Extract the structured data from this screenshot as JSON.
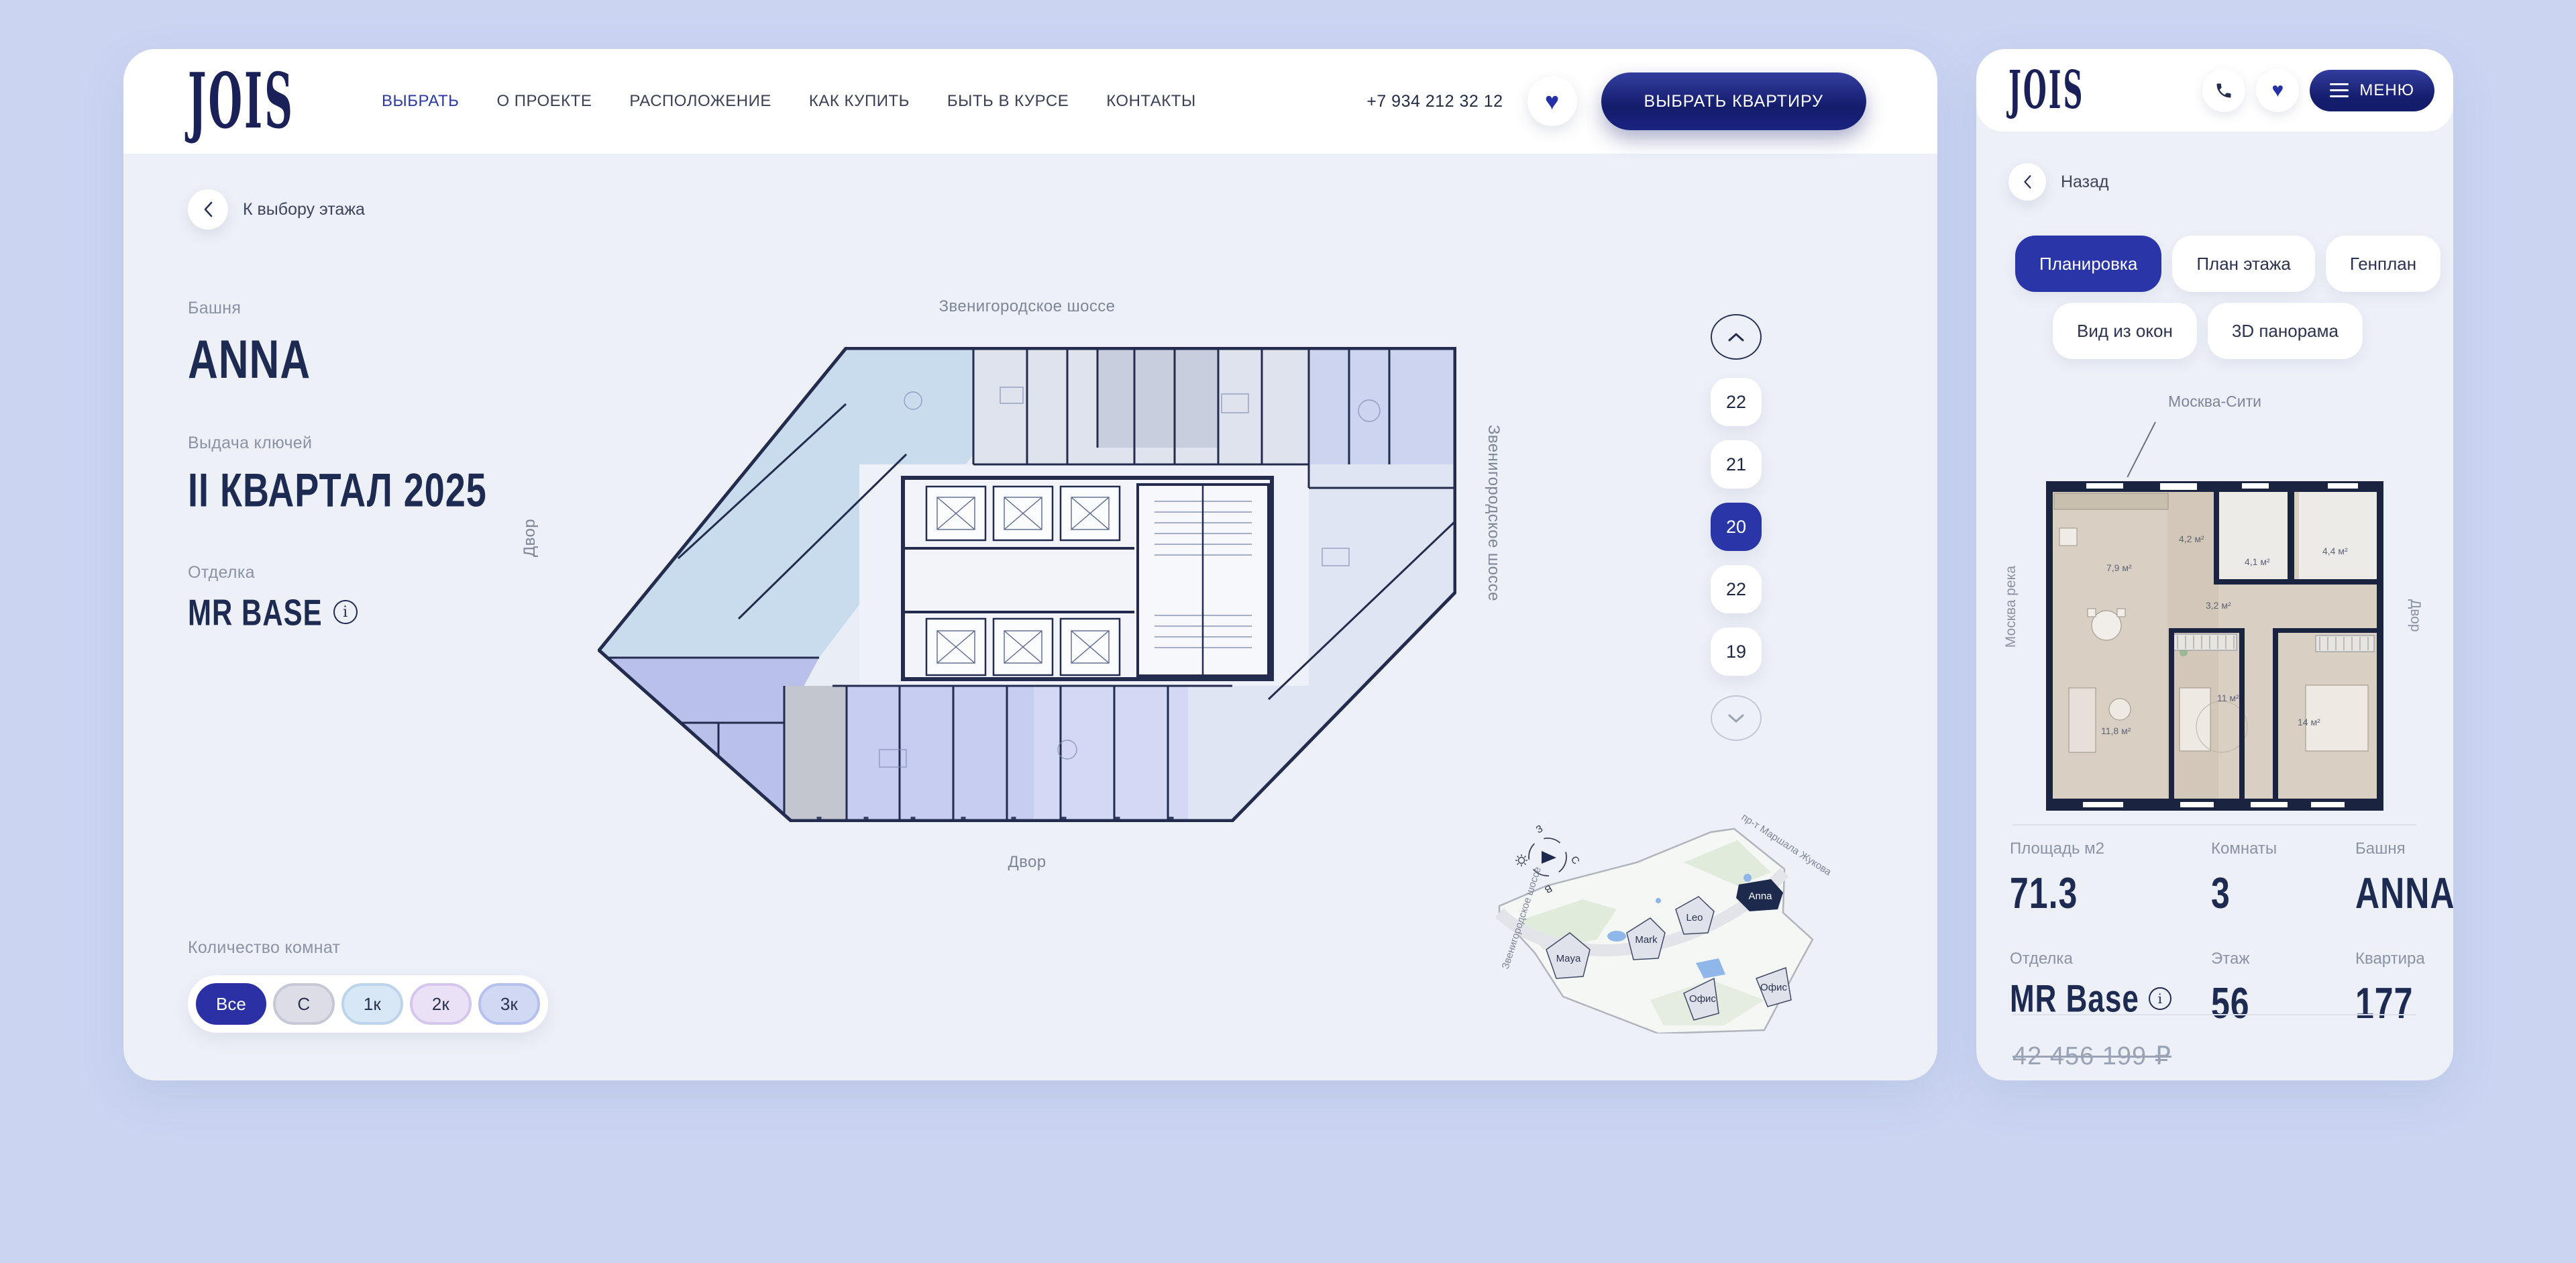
{
  "header": {
    "logo": "JOIS",
    "nav": [
      {
        "label": "ВЫБРАТЬ",
        "active": true
      },
      {
        "label": "О ПРОЕКТЕ",
        "active": false
      },
      {
        "label": "РАСПОЛОЖЕНИЕ",
        "active": false
      },
      {
        "label": "КАК КУПИТЬ",
        "active": false
      },
      {
        "label": "БЫТЬ В КУРСЕ",
        "active": false
      },
      {
        "label": "КОНТАКТЫ",
        "active": false
      }
    ],
    "phone": "+7 934 212 32 12",
    "cta": "ВЫБРАТЬ КВАРТИРУ"
  },
  "main": {
    "back": "К выбору этажа",
    "tower_label": "Башня",
    "tower": "ANNA",
    "keys_label": "Выдача ключей",
    "keys": "II КВАРТАЛ 2025",
    "finish_label": "Отделка",
    "finish": "MR BASE",
    "rooms_label": "Количество комнат",
    "filters": [
      "Все",
      "С",
      "1к",
      "2к",
      "3к"
    ],
    "plan_labels": {
      "top": "Звенигородское шоссе",
      "bottom": "Двор",
      "left": "Двор",
      "right": "Звенигородское шоссе"
    }
  },
  "floors": {
    "items": [
      "22",
      "21",
      "20",
      "22",
      "19"
    ],
    "selected_index": 2
  },
  "map": {
    "buildings": [
      "Maya",
      "Mark",
      "Leo",
      "Anna",
      "Офис",
      "Офис"
    ],
    "roads": {
      "left": "Звенигородское шоссе",
      "top": "пр-т Маршала Жукова"
    },
    "compass": {
      "n": "С",
      "w": "З",
      "e": "В"
    }
  },
  "sidebar": {
    "logo": "JOIS",
    "menu": "МЕНЮ",
    "back": "Назад",
    "tabs": [
      {
        "label": "Планировка",
        "active": true
      },
      {
        "label": "План этажа",
        "active": false
      },
      {
        "label": "Генплан",
        "active": false
      },
      {
        "label": "Вид из окон",
        "active": false
      },
      {
        "label": "3D панорама",
        "active": false
      }
    ],
    "plan": {
      "city": "Москва-Сити",
      "left": "Москва река",
      "right": "Двор",
      "rooms": [
        "7,9 м²",
        "4,2 м²",
        "4,1 м²",
        "4,4 м²",
        "3,2 м²",
        "11,8 м²",
        "11 м²",
        "14 м²"
      ]
    },
    "details": [
      {
        "label": "Площадь м2",
        "value": "71.3"
      },
      {
        "label": "Комнаты",
        "value": "3"
      },
      {
        "label": "Башня",
        "value": "ANNA"
      },
      {
        "label": "Отделка",
        "value": "MR Base"
      },
      {
        "label": "Этаж",
        "value": "56"
      },
      {
        "label": "Квартира",
        "value": "177"
      }
    ],
    "old_price": "42 456 199 ₽"
  },
  "colors": {
    "accent": "#2a35a8",
    "navy": "#1d2b52",
    "page_bg": "#cbd5f2",
    "card_bg": "#edf0f7",
    "wall": "#232c4e"
  }
}
